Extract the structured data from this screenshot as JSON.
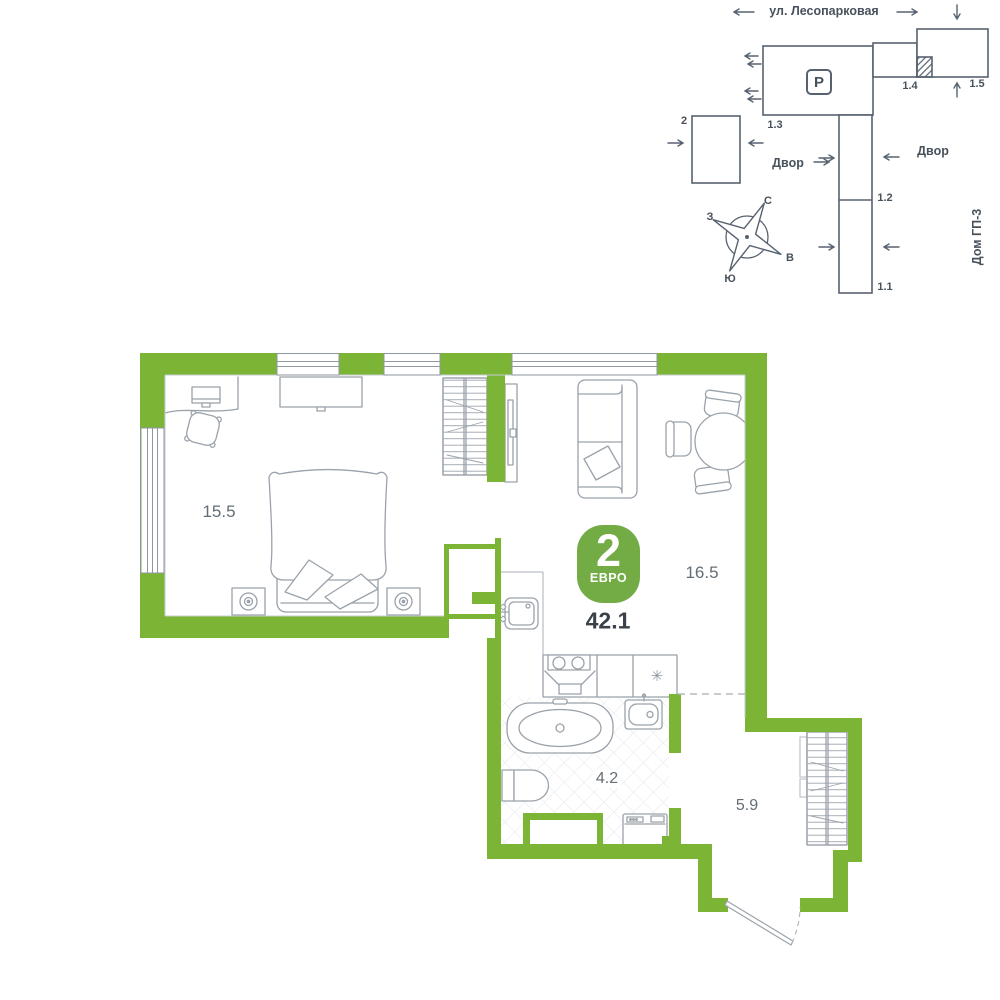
{
  "colors": {
    "wall_green": "#7cb536",
    "badge_green": "#73ac45",
    "furniture_line": "#9aa2ab",
    "site_line": "#566270",
    "text_dark": "#47525c",
    "room_label_gray": "#636d76"
  },
  "site_plan": {
    "street": "ул. Лесопарковая",
    "yard_left": "Двор",
    "yard_right": "Двор",
    "house_label": "Дом ГП-3",
    "parking": "P",
    "blocks": {
      "b2": "2",
      "b13": "1.3",
      "b14": "1.4",
      "b15": "1.5",
      "b12": "1.2",
      "b11": "1.1"
    },
    "compass": {
      "north": "С",
      "south": "Ю",
      "west": "З",
      "east": "В"
    }
  },
  "floor_plan": {
    "badge": {
      "rooms": "2",
      "type": "ЕВРО",
      "total_area": "42.1"
    },
    "rooms": {
      "bedroom": "15.5",
      "living": "16.5",
      "bathroom": "4.2",
      "hallway": "5.9"
    },
    "fridge_symbol": "✳"
  }
}
